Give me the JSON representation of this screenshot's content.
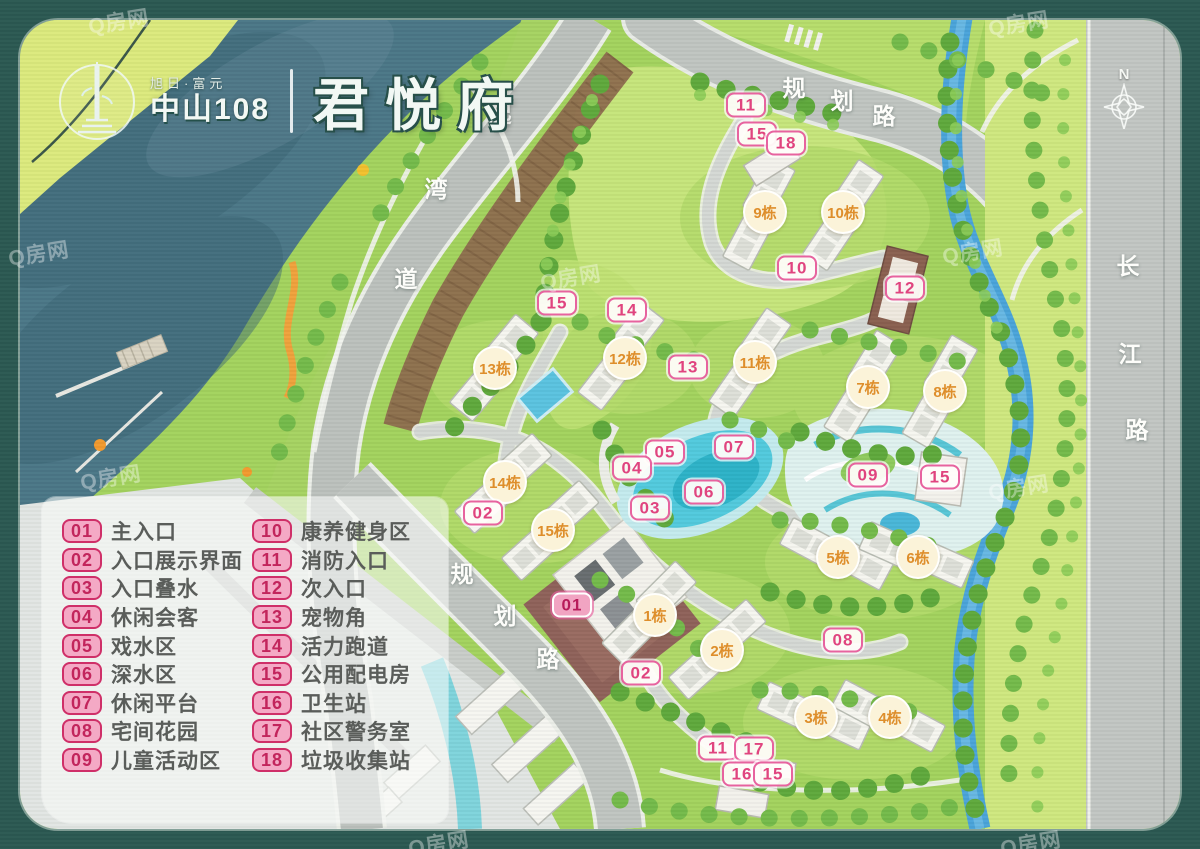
{
  "header": {
    "brand_small": "旭日·富元",
    "brand_main": "中山108",
    "project_name": "君悦府",
    "north_label": "N"
  },
  "watermark": "Q房网",
  "colors": {
    "frame_teal": "#2b5952",
    "sea": "#4b7787",
    "site_green": "#a3d35e",
    "lawn": "#c8e77e",
    "road_gray": "#c0c5c1",
    "canal_blue": "#4aa4da",
    "lake_cyan": "#52cadd",
    "marker_pink": "#e0447f",
    "building_orange": "#de8e2b",
    "plaza_brown": "#8f625a"
  },
  "legend": {
    "items": [
      {
        "num": "01",
        "label": "主入口"
      },
      {
        "num": "02",
        "label": "入口展示界面"
      },
      {
        "num": "03",
        "label": "入口叠水"
      },
      {
        "num": "04",
        "label": "休闲会客"
      },
      {
        "num": "05",
        "label": "戏水区"
      },
      {
        "num": "06",
        "label": "深水区"
      },
      {
        "num": "07",
        "label": "休闲平台"
      },
      {
        "num": "08",
        "label": "宅间花园"
      },
      {
        "num": "09",
        "label": "儿童活动区"
      },
      {
        "num": "10",
        "label": "康养健身区"
      },
      {
        "num": "11",
        "label": "消防入口"
      },
      {
        "num": "12",
        "label": "次入口"
      },
      {
        "num": "13",
        "label": "宠物角"
      },
      {
        "num": "14",
        "label": "活力跑道"
      },
      {
        "num": "15",
        "label": "公用配电房"
      },
      {
        "num": "16",
        "label": "卫生站"
      },
      {
        "num": "17",
        "label": "社区警务室"
      },
      {
        "num": "18",
        "label": "垃圾收集站"
      }
    ]
  },
  "map": {
    "point_markers": [
      {
        "num": "11",
        "x": 746,
        "y": 105
      },
      {
        "num": "15",
        "x": 757,
        "y": 134
      },
      {
        "num": "18",
        "x": 786,
        "y": 143
      },
      {
        "num": "10",
        "x": 797,
        "y": 268
      },
      {
        "num": "12",
        "x": 905,
        "y": 288
      },
      {
        "num": "15",
        "x": 557,
        "y": 303
      },
      {
        "num": "14",
        "x": 627,
        "y": 310
      },
      {
        "num": "13",
        "x": 688,
        "y": 367
      },
      {
        "num": "07",
        "x": 734,
        "y": 447
      },
      {
        "num": "05",
        "x": 665,
        "y": 452
      },
      {
        "num": "04",
        "x": 632,
        "y": 468
      },
      {
        "num": "09",
        "x": 868,
        "y": 475
      },
      {
        "num": "15",
        "x": 940,
        "y": 477
      },
      {
        "num": "06",
        "x": 704,
        "y": 492
      },
      {
        "num": "03",
        "x": 650,
        "y": 508
      },
      {
        "num": "02",
        "x": 483,
        "y": 513
      },
      {
        "num": "01",
        "x": 572,
        "y": 605,
        "highlight": true
      },
      {
        "num": "08",
        "x": 843,
        "y": 640
      },
      {
        "num": "02",
        "x": 641,
        "y": 673
      },
      {
        "num": "11",
        "x": 718,
        "y": 748
      },
      {
        "num": "17",
        "x": 754,
        "y": 749
      },
      {
        "num": "16",
        "x": 742,
        "y": 774
      },
      {
        "num": "15",
        "x": 773,
        "y": 774
      }
    ],
    "building_labels": [
      {
        "t": "1栋",
        "x": 655,
        "y": 615
      },
      {
        "t": "2栋",
        "x": 722,
        "y": 650
      },
      {
        "t": "3栋",
        "x": 816,
        "y": 717
      },
      {
        "t": "4栋",
        "x": 890,
        "y": 717
      },
      {
        "t": "5栋",
        "x": 838,
        "y": 557
      },
      {
        "t": "6栋",
        "x": 918,
        "y": 557
      },
      {
        "t": "7栋",
        "x": 868,
        "y": 387
      },
      {
        "t": "8栋",
        "x": 945,
        "y": 391
      },
      {
        "t": "9栋",
        "x": 765,
        "y": 212
      },
      {
        "t": "10栋",
        "x": 843,
        "y": 212
      },
      {
        "t": "11栋",
        "x": 755,
        "y": 362
      },
      {
        "t": "12栋",
        "x": 625,
        "y": 358
      },
      {
        "t": "13栋",
        "x": 495,
        "y": 368
      },
      {
        "t": "14栋",
        "x": 505,
        "y": 482
      },
      {
        "t": "15栋",
        "x": 553,
        "y": 530
      }
    ],
    "roads": [
      {
        "name": "规划路(北)",
        "chars": [
          {
            "t": "规",
            "x": 794,
            "y": 86
          },
          {
            "t": "划",
            "x": 842,
            "y": 99
          },
          {
            "t": "路",
            "x": 884,
            "y": 114
          }
        ]
      },
      {
        "name": "起湾道",
        "chars": [
          {
            "t": "起",
            "x": 500,
            "y": 112
          },
          {
            "t": "湾",
            "x": 436,
            "y": 187
          },
          {
            "t": "道",
            "x": 406,
            "y": 277
          }
        ]
      },
      {
        "name": "规划路(西)",
        "chars": [
          {
            "t": "规",
            "x": 462,
            "y": 572
          },
          {
            "t": "划",
            "x": 505,
            "y": 614
          },
          {
            "t": "路",
            "x": 548,
            "y": 657
          }
        ]
      },
      {
        "name": "长江路",
        "chars": [
          {
            "t": "长",
            "x": 1128,
            "y": 264
          },
          {
            "t": "江",
            "x": 1130,
            "y": 352
          },
          {
            "t": "路",
            "x": 1137,
            "y": 428
          }
        ]
      }
    ],
    "watermarks": [
      {
        "x": 88,
        "y": 6
      },
      {
        "x": 988,
        "y": 8
      },
      {
        "x": 8,
        "y": 238
      },
      {
        "x": 942,
        "y": 236
      },
      {
        "x": 80,
        "y": 462
      },
      {
        "x": 988,
        "y": 472
      },
      {
        "x": 408,
        "y": 828
      },
      {
        "x": 1000,
        "y": 828
      },
      {
        "x": 540,
        "y": 262
      }
    ]
  }
}
